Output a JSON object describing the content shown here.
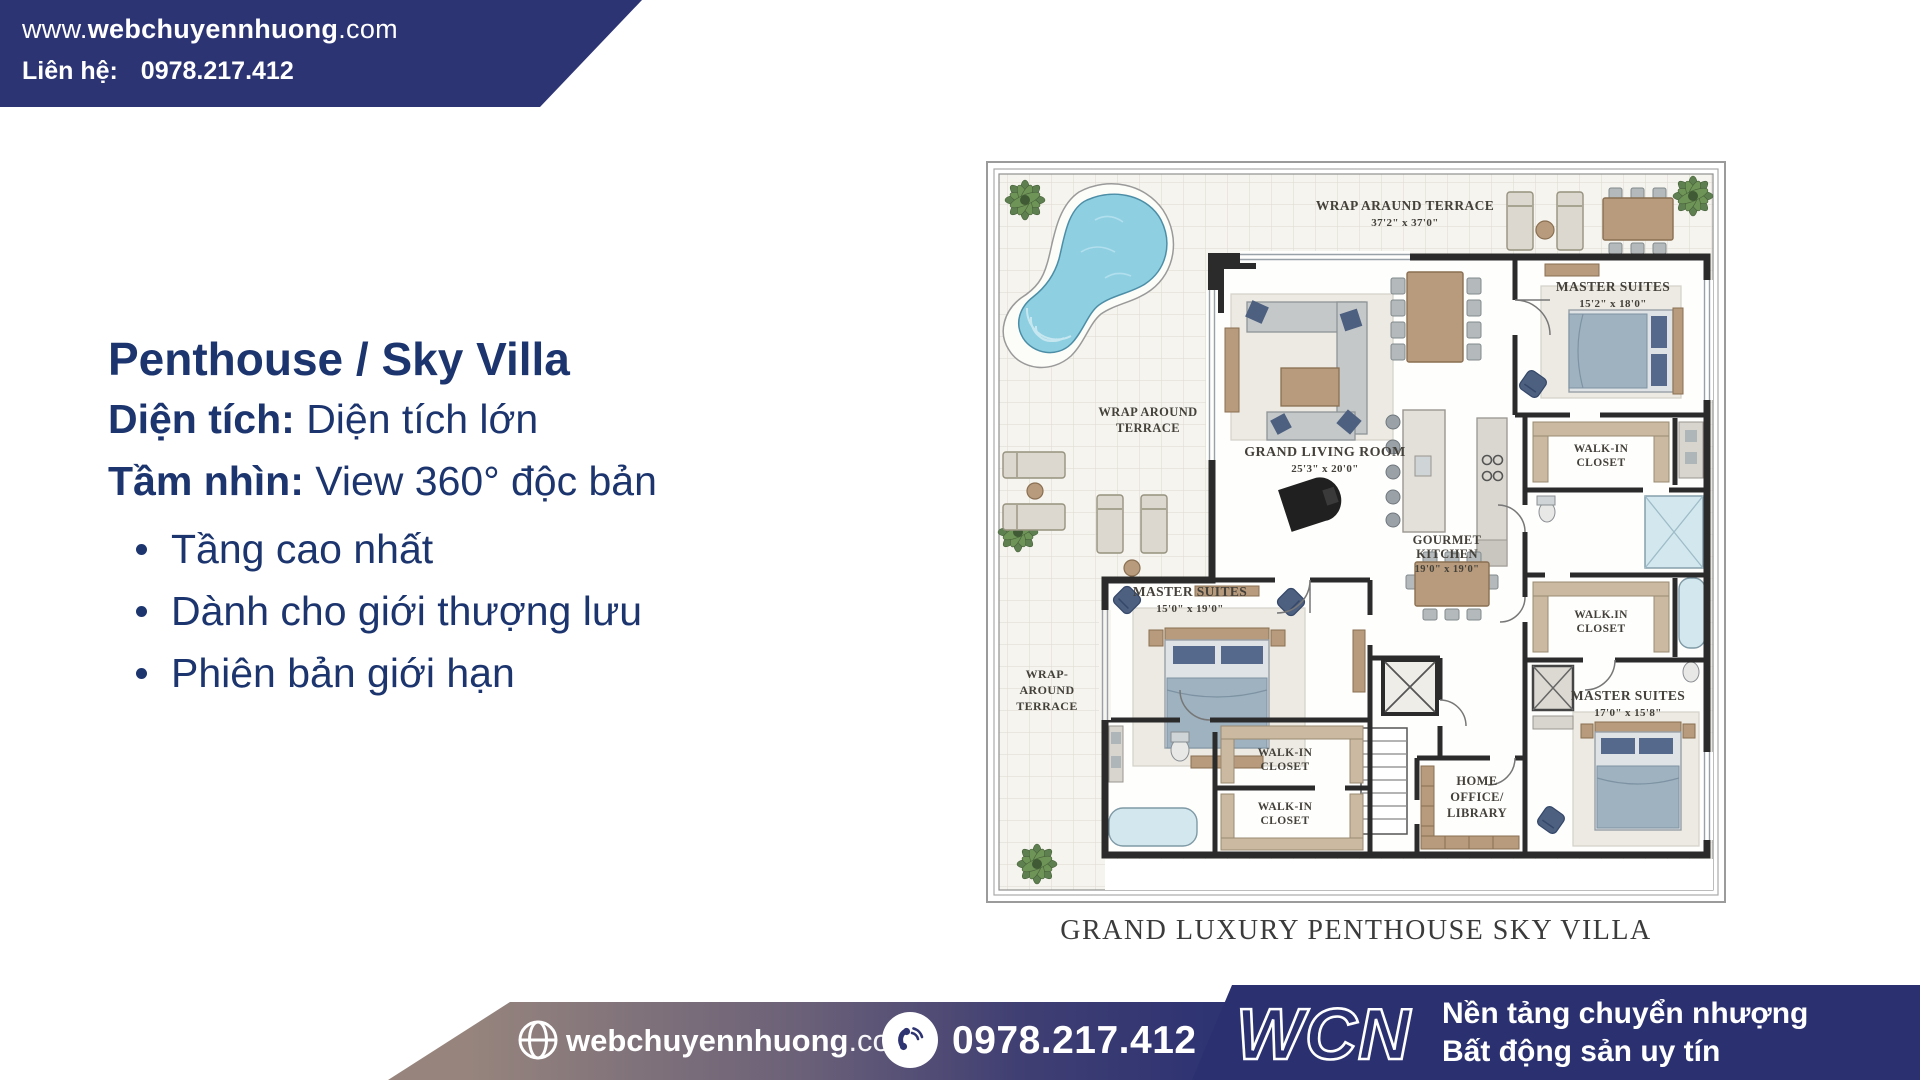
{
  "colors": {
    "banner_navy": "#2d3474",
    "text_navy": "#1c356e",
    "wcn_panel_navy": "#2b3170",
    "footer_gradient_start": "#97857d",
    "footer_gradient_end": "#2b3170",
    "pool_blue": "#8ed0e2",
    "wall_dark": "#2b2b2b"
  },
  "header": {
    "url_prefix": "www.",
    "url_bold": "webchuyennhuong",
    "url_suffix": ".com",
    "contact_label": "Liên hệ:",
    "contact_phone": "0978.217.412"
  },
  "highlight": {
    "title": "Penthouse / Sky Villa",
    "area_label": "Diện tích:",
    "area_value": "Diện tích lớn",
    "view_label": "Tầm nhìn:",
    "view_value": "View 360° độc bản",
    "bullets": [
      "Tầng cao nhất",
      "Dành cho giới thượng lưu",
      "Phiên bản giới hạn"
    ]
  },
  "floor_plan": {
    "caption": "GRAND LUXURY PENTHOUSE SKY VILLA",
    "labels": {
      "terrace_top_name": "WRAP ARAUND TERRACE",
      "terrace_top_dims": "37'2\" x 37'0\"",
      "terrace_left_1": "WRAP AROUND",
      "terrace_left_2": "TERRACE",
      "terrace_lower_1": "WRAP-",
      "terrace_lower_2": "AROUND",
      "terrace_lower_3": "TERRACE",
      "living_name": "GRAND LIVING ROOM",
      "living_dims": "25'3\" x 20'0\"",
      "kitchen_1": "GOURMET",
      "kitchen_2": "KITCHEN",
      "kitchen_dims": "19'0\" x 19'0\"",
      "master_left_name": "MASTER SUITES",
      "master_left_dims": "15'0\" x 19'0\"",
      "master_topright_name": "MASTER SUITES",
      "master_topright_dims": "15'2\" x 18'0\"",
      "master_bottomright_name": "MASTER SUITES",
      "master_bottomright_dims": "17'0\" x 15'8\"",
      "closet_right_top_1": "WALK-IN",
      "closet_right_top_2": "CLOSET",
      "closet_right_mid_1": "WALK.IN",
      "closet_right_mid_2": "CLOSET",
      "closet_center_a1": "WALK-IN",
      "closet_center_a2": "CLOSET",
      "closet_center_b1": "WALK-IN",
      "closet_center_b2": "CLOSET",
      "office_1": "HOME",
      "office_2": "OFFICE/",
      "office_3": "LIBRARY"
    }
  },
  "footer": {
    "site_bold": "webchuyennhuong",
    "site_suffix": ".com",
    "phone": "0978.217.412",
    "brand": "WCN",
    "tagline_line1": "Nền tảng chuyển nhượng",
    "tagline_line2": "Bất động sản uy tín"
  }
}
